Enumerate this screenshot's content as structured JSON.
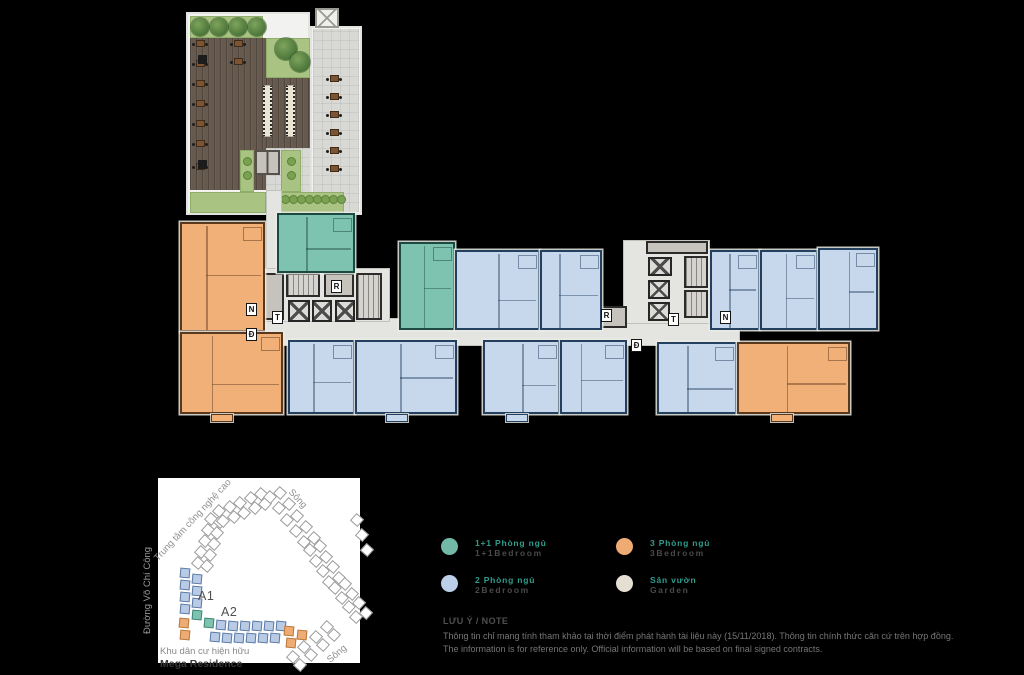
{
  "page": {
    "background": "#000000"
  },
  "legend": {
    "items": [
      {
        "id": "one-plus-one-bedroom",
        "vn": "1+1 Phòng ngủ",
        "en": "1+1Bedroom",
        "color": "#72b9a8"
      },
      {
        "id": "two-bedroom",
        "vn": "2 Phòng ngủ",
        "en": "2Bedroom",
        "color": "#bccfe8"
      },
      {
        "id": "three-bedroom",
        "vn": "3 Phòng ngủ",
        "en": "3Bedroom",
        "color": "#eeab73"
      },
      {
        "id": "garden",
        "vn": "Sân vườn",
        "en": "Garden",
        "color": "#e4dfd2"
      }
    ]
  },
  "note": {
    "title": "LƯU Ý / NOTE",
    "vietnamese": "Thông tin chỉ mang tính tham khảo tại thời điểm phát hành tài liệu này (15/11/2018). Thông tin chính thức căn cứ trên hợp đồng.",
    "english": "The information is for reference only. Official information will be based on final signed contracts."
  },
  "sitemap": {
    "river_top": "Sông",
    "river_bottom": "Sông",
    "tech_center": "Trung tâm công nghệ cao",
    "road": "Đường Võ Chí Công",
    "residential_area": "Khu dân cư hiện hữu",
    "project_name": "Mega Residence",
    "block_a1": "A1",
    "block_a2": "A2"
  },
  "floorplan": {
    "unit_types": {
      "1p1": {
        "fill": "#7ec3b0",
        "wall": "#1d4a40"
      },
      "2br": {
        "fill": "#c7d7ec",
        "wall": "#23405f"
      },
      "3br": {
        "fill": "#f0b078",
        "wall": "#59381b"
      }
    },
    "units": [
      {
        "type": "3br",
        "x": 180,
        "y": 222,
        "w": 85,
        "h": 110
      },
      {
        "type": "1p1",
        "x": 277,
        "y": 213,
        "w": 78,
        "h": 60
      },
      {
        "type": "1p1",
        "x": 399,
        "y": 242,
        "w": 56,
        "h": 88
      },
      {
        "type": "2br",
        "x": 455,
        "y": 250,
        "w": 85,
        "h": 80
      },
      {
        "type": "2br",
        "x": 540,
        "y": 250,
        "w": 62,
        "h": 80
      },
      {
        "type": "2br",
        "x": 710,
        "y": 250,
        "w": 50,
        "h": 80
      },
      {
        "type": "2br",
        "x": 760,
        "y": 250,
        "w": 58,
        "h": 80
      },
      {
        "type": "2br",
        "x": 818,
        "y": 248,
        "w": 60,
        "h": 82
      },
      {
        "type": "3br",
        "x": 180,
        "y": 332,
        "w": 103,
        "h": 82,
        "bump": true
      },
      {
        "type": "2br",
        "x": 288,
        "y": 340,
        "w": 67,
        "h": 74
      },
      {
        "type": "2br",
        "x": 355,
        "y": 340,
        "w": 102,
        "h": 74,
        "bump": true
      },
      {
        "type": "2br",
        "x": 483,
        "y": 340,
        "w": 77,
        "h": 74,
        "bump": true
      },
      {
        "type": "2br",
        "x": 560,
        "y": 340,
        "w": 67,
        "h": 74
      },
      {
        "type": "2br",
        "x": 657,
        "y": 342,
        "w": 80,
        "h": 72
      },
      {
        "type": "3br",
        "x": 737,
        "y": 342,
        "w": 113,
        "h": 72,
        "bump": true
      }
    ],
    "markers": [
      {
        "label": "N",
        "x": 246,
        "y": 303
      },
      {
        "label": "T",
        "x": 272,
        "y": 311
      },
      {
        "label": "R",
        "x": 331,
        "y": 280
      },
      {
        "label": "Đ",
        "x": 246,
        "y": 328
      },
      {
        "label": "R",
        "x": 601,
        "y": 309
      },
      {
        "label": "T",
        "x": 668,
        "y": 313
      },
      {
        "label": "N",
        "x": 720,
        "y": 311
      },
      {
        "label": "Đ",
        "x": 631,
        "y": 339
      }
    ]
  }
}
